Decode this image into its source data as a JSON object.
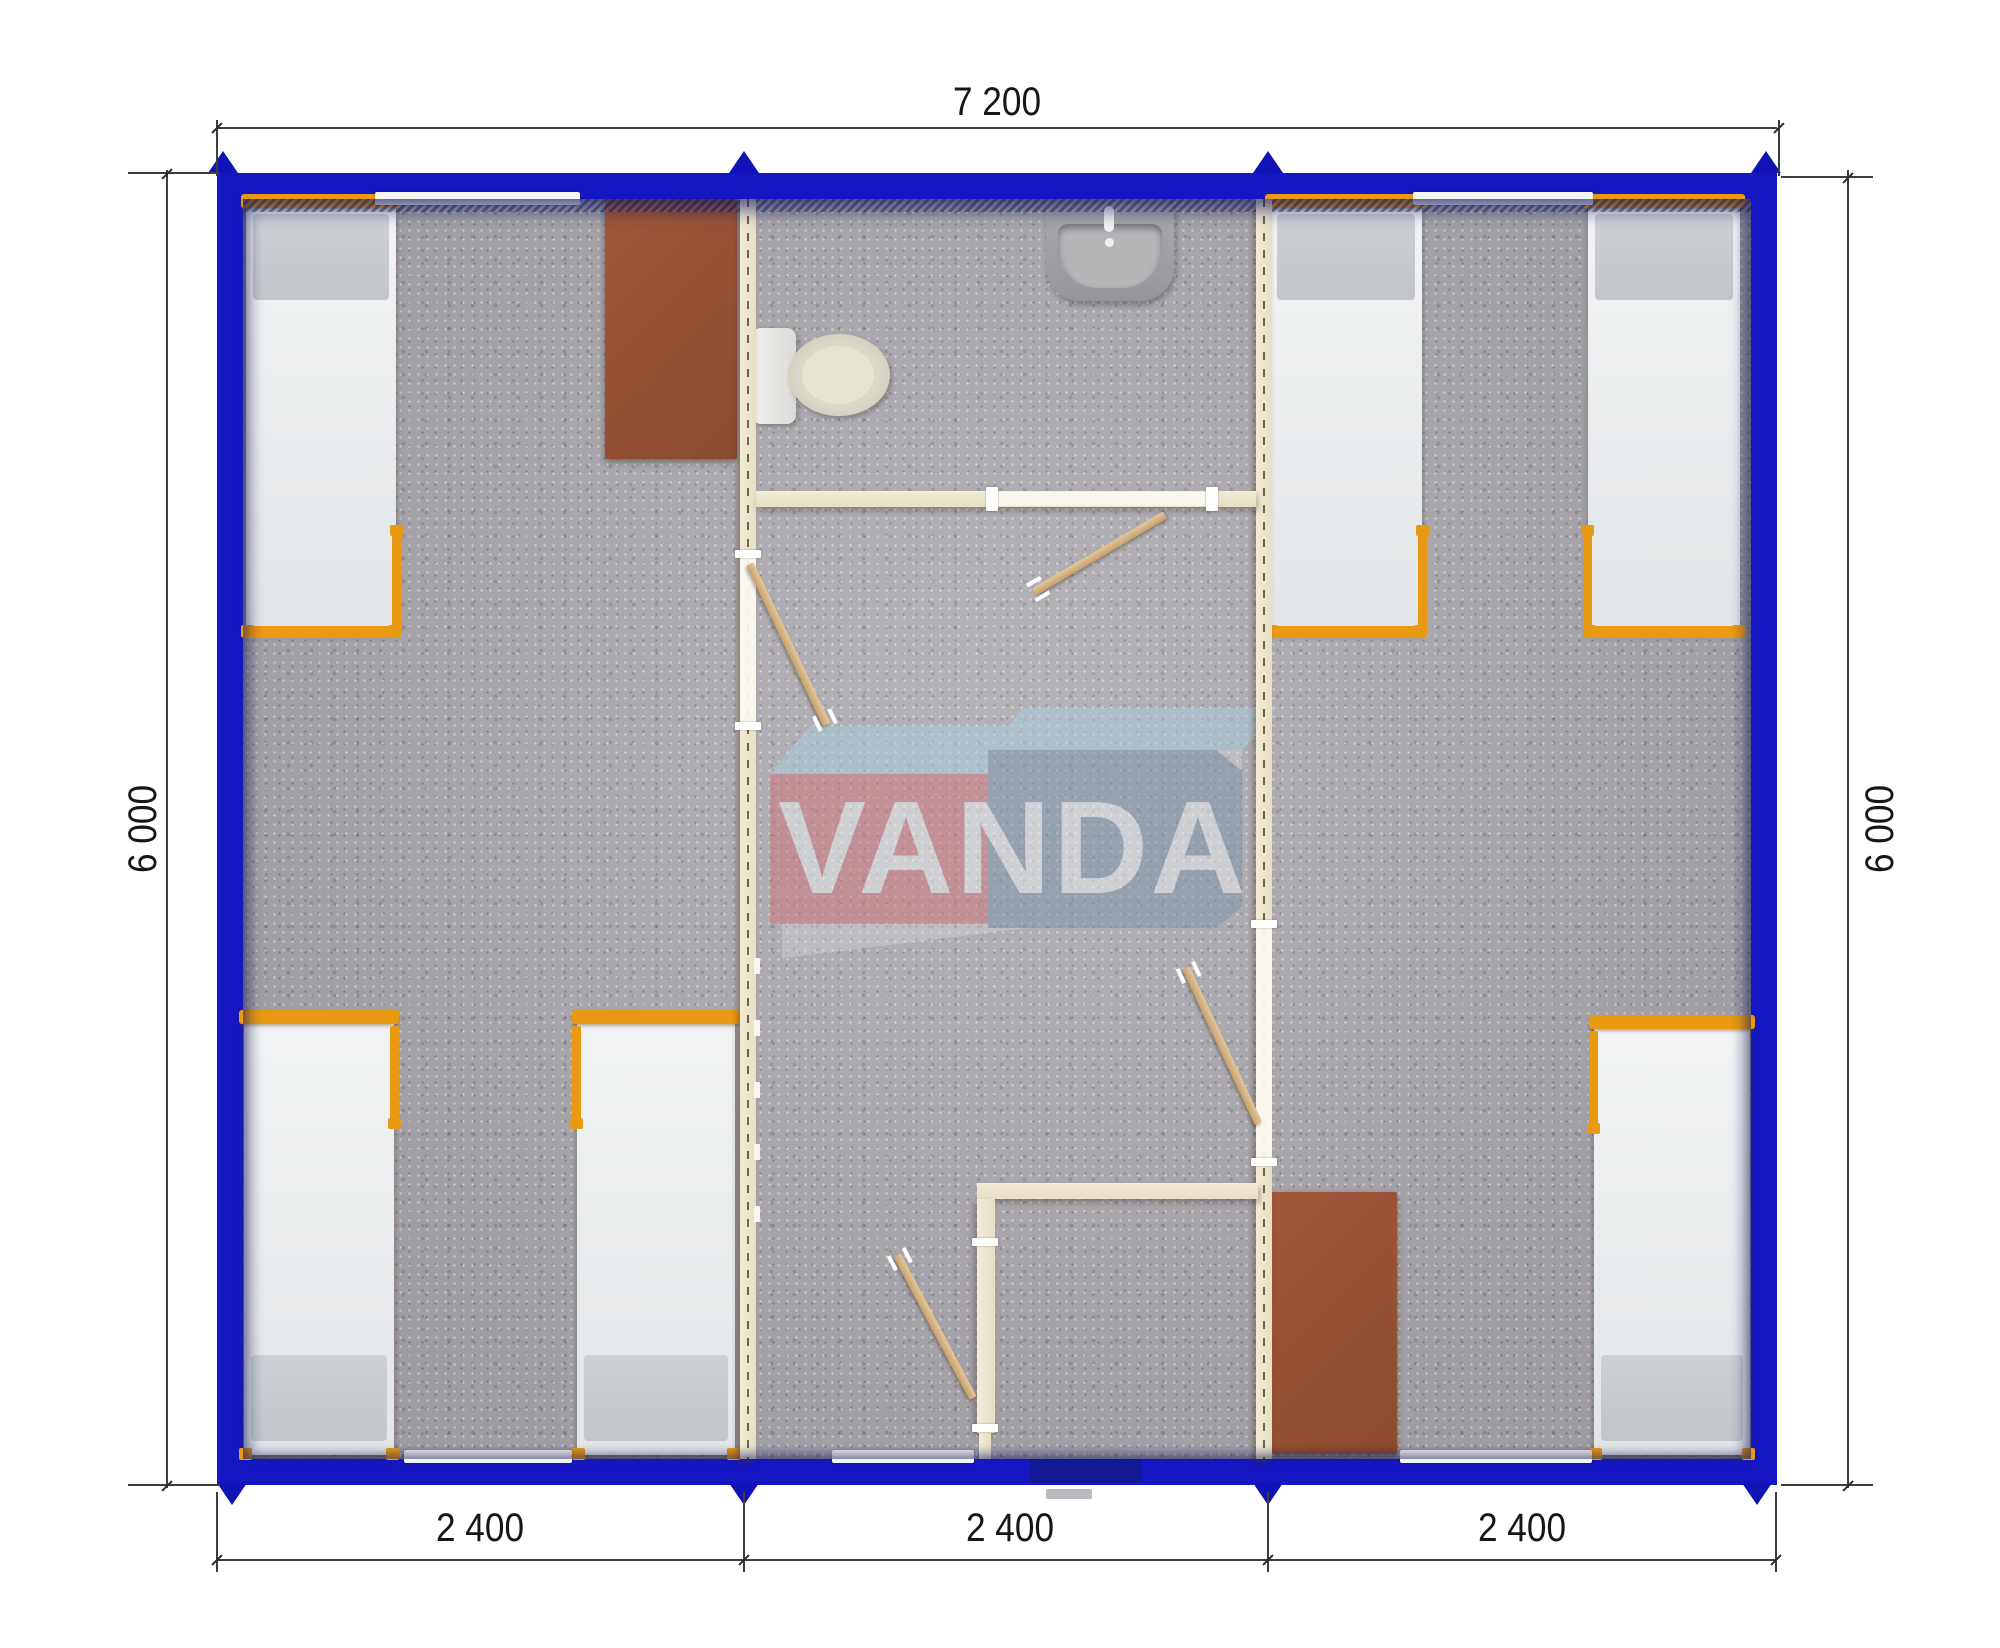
{
  "plan": {
    "watermark_text": "VANDA",
    "dim_top": "7 200",
    "dim_left": "6 000",
    "dim_right": "6 000",
    "dim_bottom": [
      "2 400",
      "2 400",
      "2 400"
    ]
  },
  "colors": {
    "exterior_wall_blue": "#1517c2",
    "wall_inner_shadow_navy": "#23276f",
    "partition_cream": "#ede6cc",
    "bed_frame_orange": "#ea9a12",
    "floor_carpet_gray": "#a8a6ab",
    "desk_brown": "#9b5136",
    "logo_red": "#d4757c",
    "logo_blue": "#7e95ac",
    "logo_top_lightblue": "#a9cfdf",
    "dimension_text": "#161616"
  }
}
